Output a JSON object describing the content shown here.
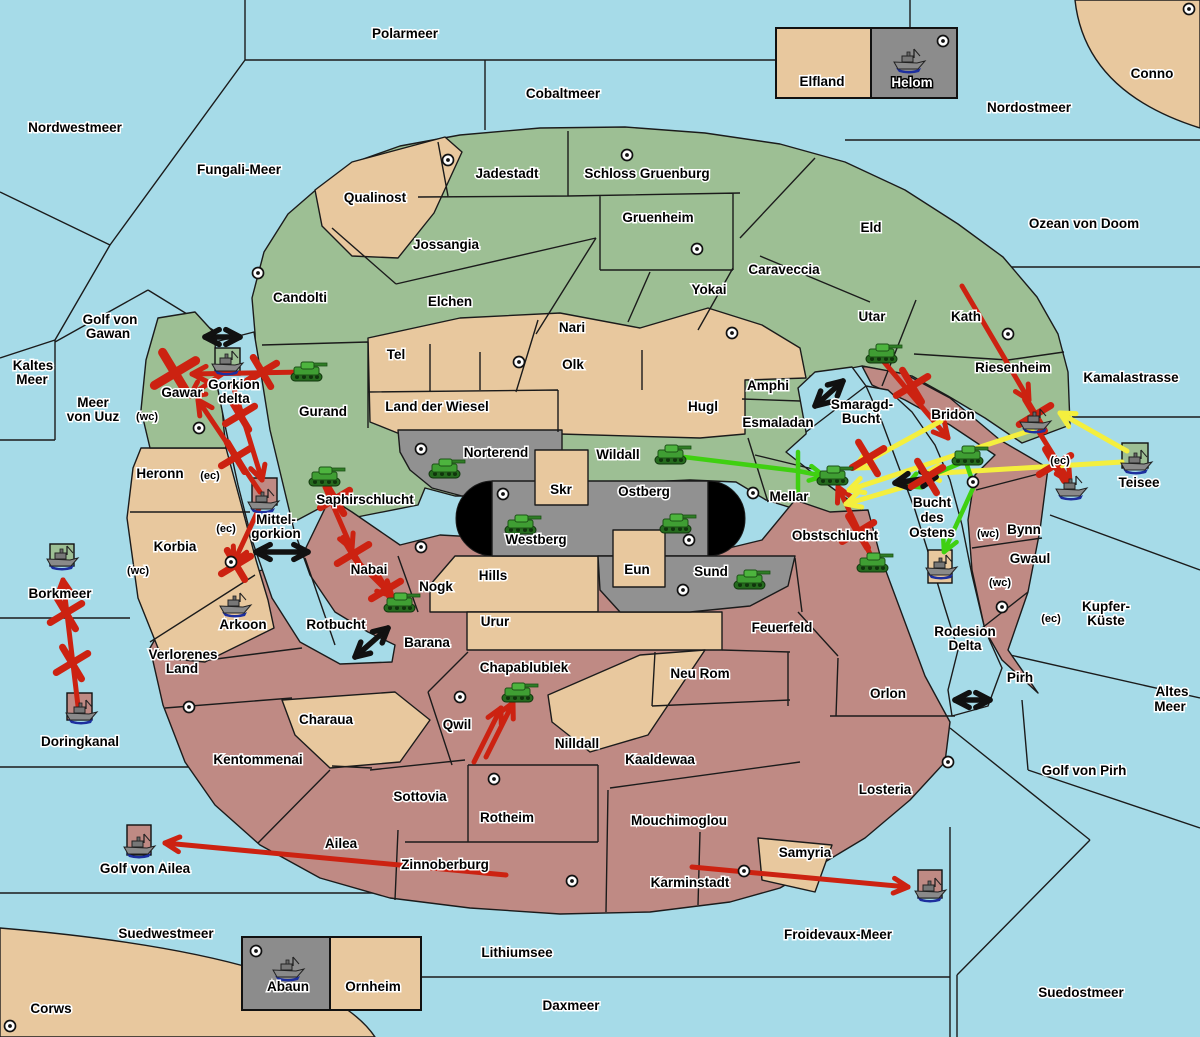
{
  "palette": {
    "sea": "#a6dbe8",
    "green": "#9dbf94",
    "tan": "#e8c89e",
    "red": "#bf8a84",
    "gray": "#919191",
    "legend_gray": "#8c8c8c",
    "capsule": "#000000",
    "arrow_red": "#cc2211",
    "arrow_yellow": "#f4ef3e",
    "arrow_green": "#3fd011",
    "arrow_black": "#111111"
  },
  "legend_top": {
    "left": "Elfland",
    "right": "Helom"
  },
  "legend_bottom": {
    "left": "Abaun",
    "right": "Ornheim"
  },
  "labels": [
    {
      "t": "Polarmeer",
      "x": 405,
      "y": 38
    },
    {
      "t": "Cobaltmeer",
      "x": 563,
      "y": 98
    },
    {
      "t": "Nordostmeer",
      "x": 1029,
      "y": 112
    },
    {
      "t": "Conno",
      "x": 1152,
      "y": 78
    },
    {
      "t": "Nordwestmeer",
      "x": 75,
      "y": 132
    },
    {
      "t": "Fungali-Meer",
      "x": 239,
      "y": 174
    },
    {
      "t": "Ozean von Doom",
      "x": 1084,
      "y": 228
    },
    {
      "t": "Kaltes",
      "x": 33,
      "y": 370
    },
    {
      "t": "Meer",
      "x": 32,
      "y": 384
    },
    {
      "t": "Meer",
      "x": 93,
      "y": 407
    },
    {
      "t": "von Uuz",
      "x": 93,
      "y": 421
    },
    {
      "t": "Golf von",
      "x": 110,
      "y": 324
    },
    {
      "t": "Gawan",
      "x": 108,
      "y": 338
    },
    {
      "t": "Borkmeer",
      "x": 60,
      "y": 598
    },
    {
      "t": "Doringkanal",
      "x": 80,
      "y": 746
    },
    {
      "t": "Golf von Ailea",
      "x": 145,
      "y": 873
    },
    {
      "t": "Suedwestmeer",
      "x": 166,
      "y": 938
    },
    {
      "t": "Corws",
      "x": 51,
      "y": 1013
    },
    {
      "t": "Lithiumsee",
      "x": 517,
      "y": 957
    },
    {
      "t": "Daxmeer",
      "x": 571,
      "y": 1010
    },
    {
      "t": "Froidevaux-Meer",
      "x": 838,
      "y": 939
    },
    {
      "t": "Suedostmeer",
      "x": 1081,
      "y": 997
    },
    {
      "t": "Golf von Pirh",
      "x": 1084,
      "y": 775
    },
    {
      "t": "Altes",
      "x": 1172,
      "y": 696
    },
    {
      "t": "Meer",
      "x": 1170,
      "y": 711
    },
    {
      "t": "Kupfer-",
      "x": 1106,
      "y": 611
    },
    {
      "t": "Küste",
      "x": 1106,
      "y": 625
    },
    {
      "t": "Kamalastrasse",
      "x": 1131,
      "y": 382
    },
    {
      "t": "Teisee",
      "x": 1139,
      "y": 487
    },
    {
      "t": "Rodesion",
      "x": 965,
      "y": 636
    },
    {
      "t": "Delta",
      "x": 965,
      "y": 650
    },
    {
      "t": "Bucht",
      "x": 932,
      "y": 507
    },
    {
      "t": "des",
      "x": 932,
      "y": 522
    },
    {
      "t": "Ostens",
      "x": 932,
      "y": 537
    },
    {
      "t": "Smaragd-",
      "x": 862,
      "y": 409
    },
    {
      "t": "Bucht",
      "x": 861,
      "y": 423
    },
    {
      "t": "Rotbucht",
      "x": 336,
      "y": 629
    },
    {
      "t": "Gorkion",
      "x": 234,
      "y": 389
    },
    {
      "t": "delta",
      "x": 234,
      "y": 403
    },
    {
      "t": "Mittel-",
      "x": 276,
      "y": 524
    },
    {
      "t": "gorkion",
      "x": 276,
      "y": 538
    },
    {
      "t": "Qualinost",
      "x": 375,
      "y": 202
    },
    {
      "t": "Candolti",
      "x": 300,
      "y": 302
    },
    {
      "t": "Jadestadt",
      "x": 507,
      "y": 178
    },
    {
      "t": "Schloss Gruenburg",
      "x": 647,
      "y": 178
    },
    {
      "t": "Gruenheim",
      "x": 658,
      "y": 222
    },
    {
      "t": "Jossangia",
      "x": 446,
      "y": 249
    },
    {
      "t": "Elchen",
      "x": 450,
      "y": 306
    },
    {
      "t": "Nari",
      "x": 572,
      "y": 332
    },
    {
      "t": "Yokai",
      "x": 709,
      "y": 294
    },
    {
      "t": "Caraveccia",
      "x": 784,
      "y": 274
    },
    {
      "t": "Eld",
      "x": 871,
      "y": 232
    },
    {
      "t": "Utar",
      "x": 872,
      "y": 321
    },
    {
      "t": "Kath",
      "x": 966,
      "y": 321
    },
    {
      "t": "Riesenheim",
      "x": 1013,
      "y": 372
    },
    {
      "t": "Tel",
      "x": 396,
      "y": 359
    },
    {
      "t": "Olk",
      "x": 573,
      "y": 369
    },
    {
      "t": "Gurand",
      "x": 323,
      "y": 416
    },
    {
      "t": "Land der Wiesel",
      "x": 437,
      "y": 411
    },
    {
      "t": "Hugl",
      "x": 703,
      "y": 411
    },
    {
      "t": "Amphi",
      "x": 768,
      "y": 390
    },
    {
      "t": "Esmaladan",
      "x": 778,
      "y": 427
    },
    {
      "t": "Gawar",
      "x": 182,
      "y": 397
    },
    {
      "t": "Heronn",
      "x": 160,
      "y": 478
    },
    {
      "t": "Korbia",
      "x": 175,
      "y": 551
    },
    {
      "t": "Saphirschlucht",
      "x": 365,
      "y": 504
    },
    {
      "t": "Norterend",
      "x": 496,
      "y": 457
    },
    {
      "t": "Wildall",
      "x": 618,
      "y": 459
    },
    {
      "t": "Skr",
      "x": 561,
      "y": 494
    },
    {
      "t": "Ostberg",
      "x": 644,
      "y": 496
    },
    {
      "t": "Westberg",
      "x": 536,
      "y": 544
    },
    {
      "t": "Mellar",
      "x": 789,
      "y": 501
    },
    {
      "t": "Hills",
      "x": 493,
      "y": 580
    },
    {
      "t": "Eun",
      "x": 637,
      "y": 574
    },
    {
      "t": "Sund",
      "x": 711,
      "y": 576
    },
    {
      "t": "Obstschlucht",
      "x": 835,
      "y": 540
    },
    {
      "t": "Bridon",
      "x": 953,
      "y": 419
    },
    {
      "t": "Bynn",
      "x": 1024,
      "y": 534
    },
    {
      "t": "Gwaul",
      "x": 1030,
      "y": 563
    },
    {
      "t": "Pirh",
      "x": 1020,
      "y": 682
    },
    {
      "t": "Nabai",
      "x": 369,
      "y": 574
    },
    {
      "t": "Nogk",
      "x": 436,
      "y": 591
    },
    {
      "t": "Urur",
      "x": 495,
      "y": 626
    },
    {
      "t": "Barana",
      "x": 427,
      "y": 647
    },
    {
      "t": "Arkoon",
      "x": 243,
      "y": 629
    },
    {
      "t": "Verlorenes",
      "x": 183,
      "y": 659
    },
    {
      "t": "Land",
      "x": 182,
      "y": 673
    },
    {
      "t": "Kentommenai",
      "x": 258,
      "y": 764
    },
    {
      "t": "Charaua",
      "x": 326,
      "y": 724
    },
    {
      "t": "Sottovia",
      "x": 420,
      "y": 801
    },
    {
      "t": "Qwil",
      "x": 457,
      "y": 729
    },
    {
      "t": "Chapablublek",
      "x": 524,
      "y": 672
    },
    {
      "t": "Nilldall",
      "x": 577,
      "y": 748
    },
    {
      "t": "Kaaldewaa",
      "x": 660,
      "y": 764
    },
    {
      "t": "Rotheim",
      "x": 507,
      "y": 822
    },
    {
      "t": "Mouchimoglou",
      "x": 679,
      "y": 825
    },
    {
      "t": "Zinnoberburg",
      "x": 445,
      "y": 869
    },
    {
      "t": "Karminstadt",
      "x": 690,
      "y": 887
    },
    {
      "t": "Neu Rom",
      "x": 700,
      "y": 678
    },
    {
      "t": "Feuerfeld",
      "x": 782,
      "y": 632
    },
    {
      "t": "Orlon",
      "x": 888,
      "y": 698
    },
    {
      "t": "Losteria",
      "x": 885,
      "y": 794
    },
    {
      "t": "Samyria",
      "x": 805,
      "y": 857
    },
    {
      "t": "Ailea",
      "x": 341,
      "y": 848
    },
    {
      "t": "(wc)",
      "x": 147,
      "y": 420,
      "s": 11
    },
    {
      "t": "(ec)",
      "x": 210,
      "y": 479,
      "s": 11
    },
    {
      "t": "(ec)",
      "x": 226,
      "y": 532,
      "s": 11
    },
    {
      "t": "(wc)",
      "x": 138,
      "y": 574,
      "s": 11
    },
    {
      "t": "(wc)",
      "x": 988,
      "y": 537,
      "s": 11
    },
    {
      "t": "(wc)",
      "x": 1000,
      "y": 586,
      "s": 11
    },
    {
      "t": "(ec)",
      "x": 1051,
      "y": 622,
      "s": 11
    },
    {
      "t": "(ec)",
      "x": 1060,
      "y": 464,
      "s": 11
    },
    {
      "t": "Elfland",
      "x": 822,
      "y": 86
    },
    {
      "t": "Helom",
      "x": 912,
      "y": 87,
      "inv": true
    },
    {
      "t": "Abaun",
      "x": 288,
      "y": 991
    },
    {
      "t": "Ornheim",
      "x": 373,
      "y": 991
    }
  ],
  "dots": [
    [
      258,
      273
    ],
    [
      448,
      160
    ],
    [
      627,
      155
    ],
    [
      697,
      249
    ],
    [
      732,
      333
    ],
    [
      1189,
      9
    ],
    [
      1008,
      334
    ],
    [
      943,
      41
    ],
    [
      199,
      428
    ],
    [
      519,
      362
    ],
    [
      421,
      449
    ],
    [
      503,
      494
    ],
    [
      753,
      493
    ],
    [
      689,
      540
    ],
    [
      683,
      590
    ],
    [
      421,
      547
    ],
    [
      231,
      562
    ],
    [
      460,
      697
    ],
    [
      973,
      482
    ],
    [
      1002,
      607
    ],
    [
      189,
      707
    ],
    [
      494,
      779
    ],
    [
      572,
      881
    ],
    [
      744,
      871
    ],
    [
      948,
      762
    ],
    [
      10,
      1026
    ],
    [
      256,
      951
    ]
  ],
  "tanks": [
    [
      307,
      373
    ],
    [
      882,
      355
    ],
    [
      445,
      470
    ],
    [
      671,
      456
    ],
    [
      521,
      526
    ],
    [
      676,
      525
    ],
    [
      750,
      581
    ],
    [
      325,
      478
    ],
    [
      400,
      604
    ],
    [
      518,
      694
    ],
    [
      873,
      564
    ],
    [
      833,
      477
    ],
    [
      968,
      457
    ]
  ],
  "ships": [
    [
      909,
      60
    ],
    [
      288,
      968
    ],
    [
      227,
      362
    ],
    [
      263,
      500
    ],
    [
      62,
      557
    ],
    [
      235,
      604
    ],
    [
      81,
      711
    ],
    [
      139,
      845
    ],
    [
      930,
      889
    ],
    [
      1035,
      420
    ],
    [
      1071,
      487
    ],
    [
      1136,
      461
    ],
    [
      941,
      566
    ]
  ],
  "squares": [
    {
      "x": 215,
      "y": 348,
      "w": 25,
      "h": 27,
      "c": "green"
    },
    {
      "x": 252,
      "y": 478,
      "w": 25,
      "h": 27,
      "c": "red"
    },
    {
      "x": 50,
      "y": 544,
      "w": 24,
      "h": 22,
      "c": "green"
    },
    {
      "x": 67,
      "y": 693,
      "w": 25,
      "h": 27,
      "c": "red"
    },
    {
      "x": 127,
      "y": 825,
      "w": 24,
      "h": 30,
      "c": "red"
    },
    {
      "x": 918,
      "y": 870,
      "w": 24,
      "h": 28,
      "c": "red"
    },
    {
      "x": 1122,
      "y": 443,
      "w": 26,
      "h": 25,
      "c": "green"
    },
    {
      "x": 928,
      "y": 550,
      "w": 24,
      "h": 33,
      "c": "tan"
    }
  ],
  "xmarks": [
    {
      "x": 175,
      "y": 373,
      "s": 34
    },
    {
      "x": 262,
      "y": 372,
      "s": 24
    },
    {
      "x": 240,
      "y": 415,
      "s": 24
    },
    {
      "x": 236,
      "y": 457,
      "s": 24
    },
    {
      "x": 236,
      "y": 565,
      "s": 24
    },
    {
      "x": 353,
      "y": 554,
      "s": 26
    },
    {
      "x": 386,
      "y": 590,
      "s": 24
    },
    {
      "x": 335,
      "y": 499,
      "s": 24
    },
    {
      "x": 66,
      "y": 613,
      "s": 26
    },
    {
      "x": 72,
      "y": 663,
      "s": 26
    },
    {
      "x": 912,
      "y": 386,
      "s": 26
    },
    {
      "x": 868,
      "y": 458,
      "s": 26
    },
    {
      "x": 927,
      "y": 477,
      "s": 26
    },
    {
      "x": 858,
      "y": 532,
      "s": 26
    },
    {
      "x": 1035,
      "y": 415,
      "s": 26
    },
    {
      "x": 1055,
      "y": 465,
      "s": 26
    }
  ],
  "arrows": {
    "red": [
      [
        305,
        372,
        192,
        374,
        "end"
      ],
      [
        228,
        370,
        190,
        396,
        "end"
      ],
      [
        232,
        382,
        262,
        480,
        "end"
      ],
      [
        260,
        492,
        198,
        400,
        "end"
      ],
      [
        262,
        502,
        234,
        562,
        "end"
      ],
      [
        325,
        487,
        352,
        549,
        "end"
      ],
      [
        352,
        556,
        392,
        596,
        "end"
      ],
      [
        78,
        706,
        63,
        580,
        "end"
      ],
      [
        884,
        362,
        948,
        438,
        "end"
      ],
      [
        962,
        286,
        1029,
        400,
        "end"
      ],
      [
        1039,
        432,
        1070,
        482,
        "end"
      ],
      [
        871,
        556,
        838,
        487,
        "end"
      ],
      [
        486,
        757,
        513,
        703,
        "end"
      ],
      [
        474,
        762,
        501,
        708,
        "end"
      ],
      [
        506,
        875,
        165,
        843,
        "end"
      ],
      [
        692,
        867,
        908,
        887,
        "end"
      ]
    ],
    "yellow": [
      [
        1127,
        451,
        1060,
        413,
        "end"
      ],
      [
        1122,
        462,
        925,
        474,
        "end"
      ],
      [
        1032,
        430,
        849,
        490,
        "end"
      ],
      [
        941,
        421,
        855,
        468,
        "end"
      ],
      [
        931,
        479,
        846,
        504,
        "end"
      ]
    ],
    "green": [
      [
        684,
        457,
        798,
        471,
        "none"
      ],
      [
        798,
        452,
        798,
        494,
        "none"
      ],
      [
        798,
        471,
        824,
        476,
        "end"
      ],
      [
        966,
        462,
        974,
        486,
        "none"
      ],
      [
        974,
        486,
        944,
        552,
        "end"
      ],
      [
        961,
        463,
        906,
        486,
        "end"
      ]
    ],
    "black": [
      [
        205,
        337,
        240,
        337,
        "both"
      ],
      [
        256,
        552,
        308,
        552,
        "both"
      ],
      [
        355,
        657,
        388,
        628,
        "both"
      ],
      [
        815,
        406,
        843,
        381,
        "both"
      ],
      [
        895,
        483,
        936,
        477,
        "both"
      ],
      [
        955,
        700,
        990,
        700,
        "both"
      ]
    ]
  }
}
